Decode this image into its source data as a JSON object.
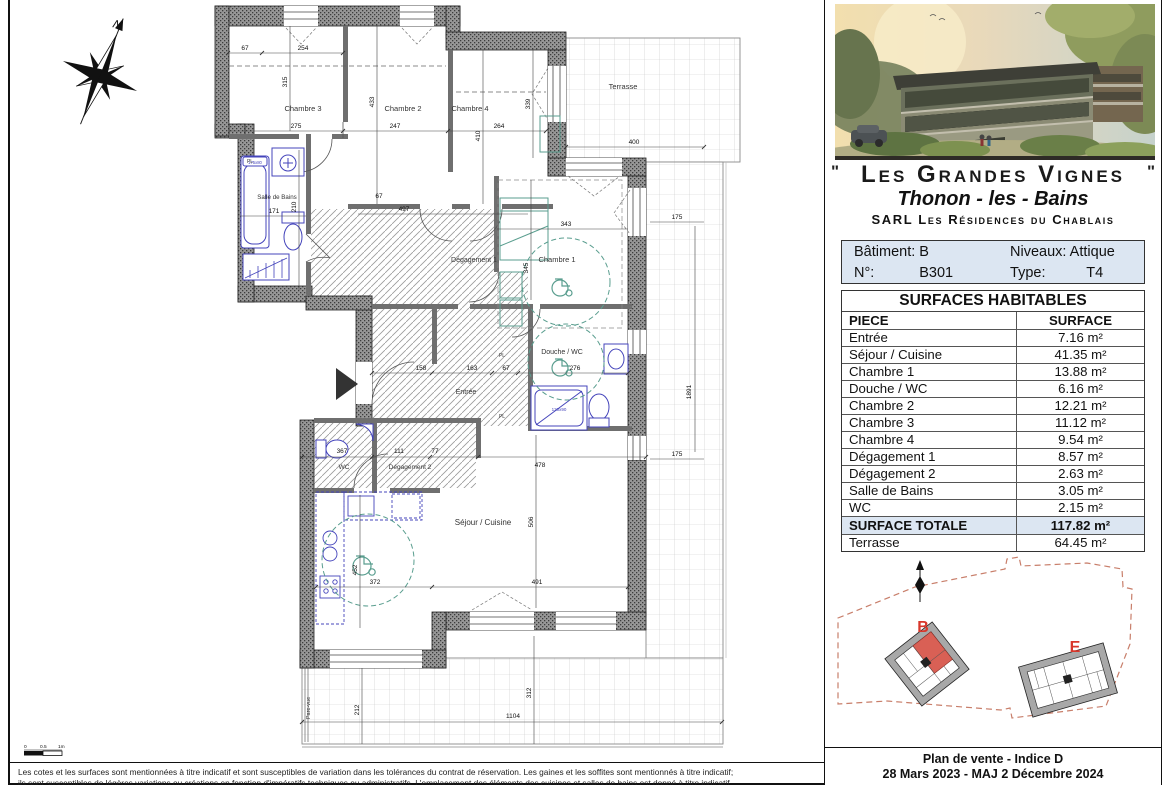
{
  "sheet": {
    "disclaimer_line1": "Les cotes et les surfaces sont mentionnées à titre indicatif et sont susceptibles de variation dans les tolérances du contrat de réservation. Les gaines et les soffites sont mentionnés à titre indicatif;",
    "disclaimer_line2": "ils sont susceptibles de légères variations ou créations en fonction d'impératifs techniques ou administratifs.  L'emplacement des éléments des cuisines et salles de bains est donné à titre indicatif."
  },
  "compass": {
    "north": "N"
  },
  "scale_bar": {
    "zero": "0",
    "half": "0.5",
    "one": "1m"
  },
  "plan": {
    "rooms": {
      "chambre3": "Chambre 3",
      "chambre2": "Chambre 2",
      "chambre4": "Chambre 4",
      "chambre1": "Chambre 1",
      "salle_de_bains": "Salle de Bains",
      "degagement1": "Dégagement 1",
      "degagement2": "Dégagement 2",
      "douche_wc": "Douche / WC",
      "entree": "Entrée",
      "wc": "WC",
      "sejour_cuisine": "Séjour / Cuisine",
      "terrasse": "Terrasse",
      "pare_vue": "Pare-vue"
    },
    "fixtures": {
      "bathtub_size": "175x80",
      "shower_size": "120x90",
      "placard": "PL"
    },
    "dims": {
      "ch3_left": "67",
      "ch3_w": "254",
      "ch3_h": "315",
      "ch3_w2": "275",
      "ch2_h": "433",
      "ch2_w": "247",
      "ch4_w": "264",
      "ch4_h": "410",
      "ch4_h2": "339",
      "terr_top": "400",
      "terr_r1": "175",
      "terr_r": "1891",
      "terr_r2": "175",
      "ch1_w": "343",
      "ch1_h": "345",
      "deg1_w": "497",
      "deg1_c": "67",
      "sdb_w": "171",
      "sdb_h": "210",
      "ent_a": "158",
      "ent_b": "163",
      "ent_c": "67",
      "douche_w": "276",
      "mid": "478",
      "wc_w": "367",
      "deg2_w": "111",
      "deg2_b": "77",
      "sej_h": "506",
      "sej_h2": "452",
      "sej_w": "372",
      "sej_w2": "491",
      "bterr_h": "212",
      "bterr_h2": "312",
      "bterr_w": "1104"
    }
  },
  "panel": {
    "quote_mark": "\"",
    "title": "Les Grandes Vignes",
    "subtitle": "Thonon - les - Bains",
    "company": "SARL Les Résidences du Chablais",
    "info": {
      "row1_left": "Bâtiment: B",
      "row1_right": "Niveaux: Attique",
      "numero_label": "N°:",
      "numero": "B301",
      "type_label": "Type:",
      "type": "T4"
    },
    "surfaces": {
      "title": "SURFACES HABITABLES",
      "col_piece": "PIECE",
      "col_surface": "SURFACE",
      "rows": [
        {
          "piece": "Entrée",
          "surface": "7.16 m²"
        },
        {
          "piece": "Séjour / Cuisine",
          "surface": "41.35 m²"
        },
        {
          "piece": "Chambre 1",
          "surface": "13.88 m²"
        },
        {
          "piece": "Douche / WC",
          "surface": "6.16 m²"
        },
        {
          "piece": "Chambre 2",
          "surface": "12.21 m²"
        },
        {
          "piece": "Chambre 3",
          "surface": "11.12 m²"
        },
        {
          "piece": "Chambre 4",
          "surface": "9.54 m²"
        },
        {
          "piece": "Dégagement 1",
          "surface": "8.57 m²"
        },
        {
          "piece": "Dégagement 2",
          "surface": "2.63 m²"
        },
        {
          "piece": "Salle de Bains",
          "surface": "3.05 m²"
        },
        {
          "piece": "WC",
          "surface": "2.15 m²"
        }
      ],
      "total_label": "SURFACE TOTALE",
      "total": "117.82 m²",
      "terrasse_label": "Terrasse",
      "terrasse": "64.45 m²"
    },
    "site_plan": {
      "building_b": "B",
      "building_e": "E"
    },
    "footer_line1": "Plan de vente - Indice D",
    "footer_line2": "28 Mars 2023 - MAJ 2 Décembre 2024"
  },
  "colors": {
    "accent_red": "#d8372b",
    "table_header_bg": "#dce6f2",
    "boundary_dash": "#c87e6a",
    "fixture_blue": "#4444bb",
    "furniture_teal": "#5a9e8f",
    "wall_gray": "#8c8c8c"
  }
}
